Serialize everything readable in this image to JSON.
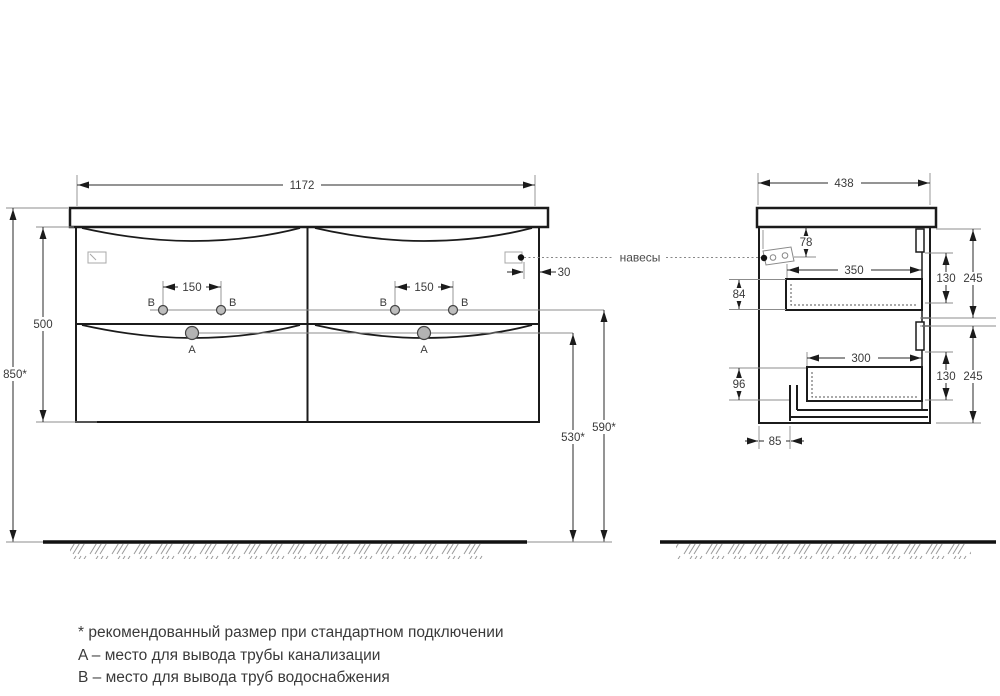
{
  "front": {
    "width": "1172",
    "height": "500",
    "total_height": "850*",
    "tap_spacing": "150",
    "hanger_side_offset": "30",
    "drain_height": "530*",
    "water_height": "590*",
    "point_a": "A",
    "point_b": "B"
  },
  "side": {
    "depth": "438",
    "hanger_top_offset": "78",
    "drawer_top_depth": "350",
    "front_top": "130",
    "section_top": "245",
    "drawer_top_height": "84",
    "drawer_bottom_depth": "300",
    "front_bottom": "130",
    "section_bottom": "245",
    "drawer_bottom_height": "96",
    "bottom_offset": "85"
  },
  "callout": "навесы",
  "notes": {
    "star": "* рекомендованный размер при стандартном подключении",
    "a": "A – место для вывода трубы канализации",
    "b": "B – место для вывода труб водоснабжения"
  }
}
